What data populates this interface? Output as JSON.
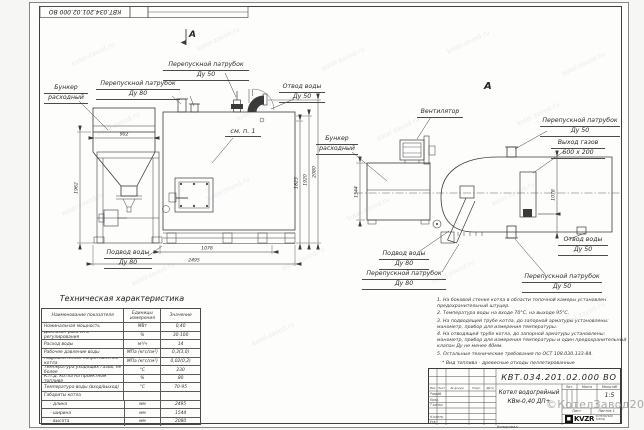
{
  "colors": {
    "ink": "#3a3a3a",
    "paper": "#fdfdfc",
    "watermark": "#a0a0a0"
  },
  "frame": {
    "stamp_number": "КВТ.034.201.02.000 ВО"
  },
  "front_view": {
    "marker": "А",
    "see_ref": "см. п. 1",
    "callouts": {
      "hopper_l1": "Бункер",
      "hopper_l2": "расходный",
      "bypass80_l1": "Перепускной патрубок",
      "bypass80_l2": "Ду 80",
      "bypass50_l1": "Перепускной патрубок",
      "bypass50_l2": "Ду 50",
      "outlet_l1": "Отвод воды",
      "outlet_l2": "Ду 50",
      "inlet_l1": "Подвод воды",
      "inlet_l2": "Ду 80"
    },
    "dims": {
      "hopper_width": "902",
      "height_left": "1962",
      "h1": "1825",
      "h2": "1920",
      "h3": "2080",
      "base": "1078",
      "length": "2495"
    }
  },
  "side_view": {
    "marker": "А",
    "callouts": {
      "fan": "Вентилятор",
      "hopper_l1": "Бункер",
      "hopper_l2": "расходный",
      "bypass50_top_l1": "Перепускной патрубок",
      "bypass50_top_l2": "Ду 50",
      "gas_l1": "Выход газов",
      "gas_l2": "600 х 200",
      "outlet_l1": "Отвод воды",
      "outlet_l2": "Ду 50",
      "inlet_l1": "Подвод воды",
      "inlet_l2": "Ду 80",
      "bypass80_l1": "Перепускной патрубок",
      "bypass80_l2": "Ду 80",
      "bypass50_bot_l1": "Перепускной патрубок",
      "bypass50_bot_l2": "Ду 50"
    },
    "dims": {
      "width": "1544",
      "height": "1078"
    }
  },
  "tech_table": {
    "title": "Техническая характеристика",
    "headers": [
      "Наименование показателя",
      "Единицы измерения",
      "Значение"
    ],
    "rows": [
      {
        "name": "Номинальная мощность",
        "unit": "МВт",
        "value": "0,40"
      },
      {
        "name": "Диапазон рабочего регулирования",
        "unit": "%",
        "value": "30-100"
      },
      {
        "name": "Расход воды",
        "unit": "м³/ч",
        "value": "14"
      },
      {
        "name": "Рабочее давление воды",
        "unit": "МПа (кгс/см²)",
        "value": "0,3(3,0)"
      },
      {
        "name": "Гидравлическое сопротивление котла",
        "unit": "МПа (кгс/см²)",
        "value": "0,02(0,2)"
      },
      {
        "name": "Температура уходящих газов, не более",
        "unit": "°С",
        "value": "230"
      },
      {
        "name": "К.П.Д. котла на проектном топливе",
        "unit": "%",
        "value": "80"
      },
      {
        "name": "Температура воды (вход/выход)",
        "unit": "°С",
        "value": "70-95"
      },
      {
        "name": "Габариты котла",
        "unit": "",
        "value": ""
      },
      {
        "name": "- длина",
        "unit": "мм",
        "value": "2495"
      },
      {
        "name": "- ширина",
        "unit": "мм",
        "value": "1544"
      },
      {
        "name": "- высота",
        "unit": "мм",
        "value": "2080"
      }
    ]
  },
  "notes": {
    "items": [
      "1. На боковой стенке котла в области топочной камеры установлен предохранительный штуцер.",
      "2. Температура воды на входе 70°С, на выходе 95°С.",
      "3. На подводящей трубе котла, до запорной арматуры установлены: манометр, прибор для измерения температуры.",
      "4. На отводящей трубе котла, до запорной арматуры установлены: манометр, прибор для измерения температуры и один предохранительный клапан Ду не менее 40мм.",
      "5. Остальные технические требования по ОСТ 108.030.133-84."
    ],
    "fuel": "* Вид топлива - древесные отходы пеллетированные"
  },
  "title_block": {
    "number": "КВТ.034.201.02.000  ВО",
    "name_l1": "Котел водогрейный",
    "name_l2": "КВм-0,40 ДП+",
    "scale": "1:5",
    "headers": {
      "lit": "Лит.",
      "mass": "Масса",
      "scale": "Масштаб"
    },
    "sheet": "Лист",
    "sheets": "Листов 1",
    "logo": "KVZR",
    "logo_caption_l1": "КОТЕЛЬНЫЙ",
    "logo_caption_l2": "ЗАВОД",
    "stamp_cols": [
      "Изм.",
      "Лист",
      "№ докум.",
      "Подп.",
      "Дата"
    ],
    "stamp_rows": [
      "Разраб.",
      "Пров.",
      "Т.контр.",
      "Н.контр.",
      "Утв."
    ],
    "kopiroval": "Копировал"
  },
  "watermark": {
    "corner": "©КотелЗавод2021",
    "tile": "kotel-zavod.ru"
  }
}
